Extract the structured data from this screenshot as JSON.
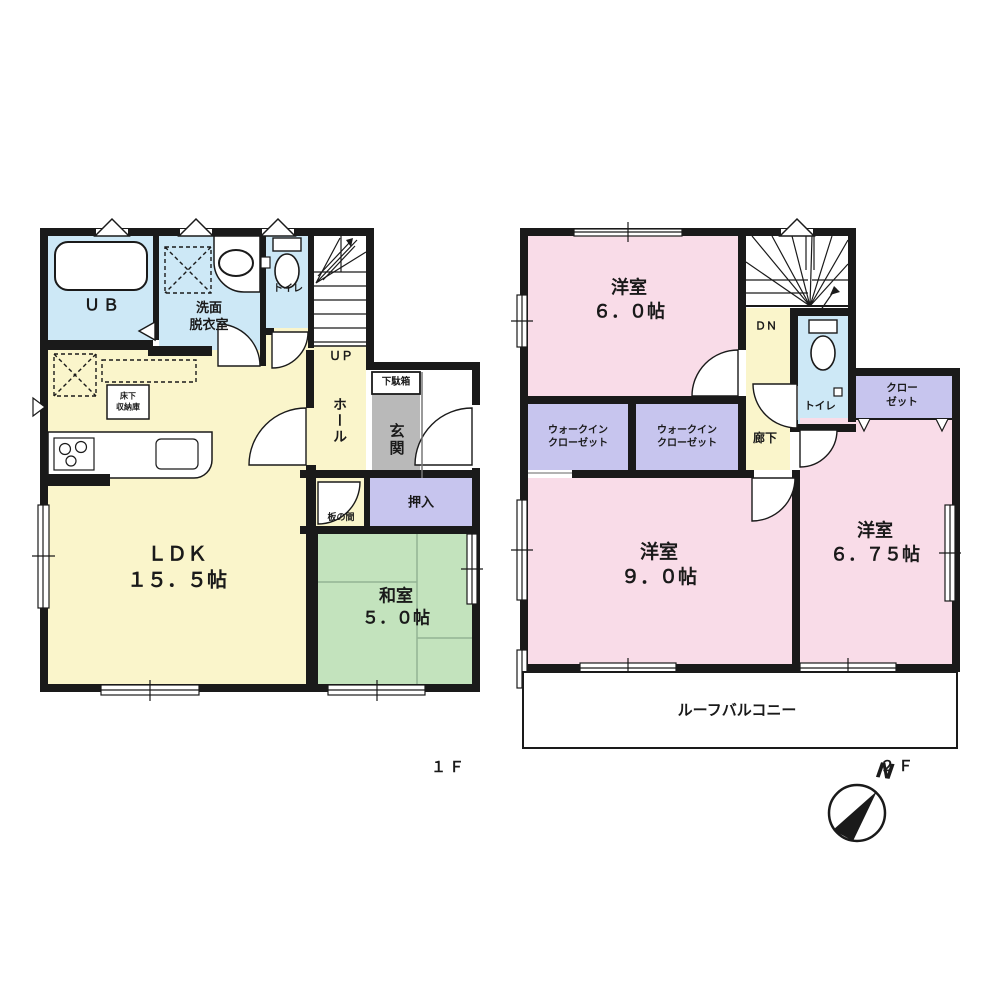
{
  "colors": {
    "wall": "#1A1A1A",
    "wood_floor": "#FAF5CB",
    "wet_area": "#CDE8F6",
    "tatami": "#C3E3BD",
    "storage": "#C7C5EE",
    "bedroom": "#F9DCE8",
    "entrance_gray": "#B9B9B9",
    "white": "#FFFFFF"
  },
  "f1": {
    "floor_label": "１Ｆ",
    "ub": "ＵＢ",
    "washroom": "洗面\n脱衣室",
    "toilet": "トイレ",
    "up": "ＵＰ",
    "hall": "ホール",
    "shoebox": "下駄箱",
    "entrance": "玄関",
    "underfloor_storage": "床下\n収納庫",
    "ldk": "ＬＤＫ\n１５．５帖",
    "itanoma": "板の間",
    "oshiire": "押入",
    "washitsu": "和室\n５．０帖"
  },
  "f2": {
    "floor_label": "２Ｆ",
    "bedroom6": "洋室\n６．０帖",
    "dn": "ＤＮ",
    "toilet": "トイレ",
    "closet": "クロー\nゼット",
    "wic1": "ウォークイン\nクローゼット",
    "wic2": "ウォークイン\nクローゼット",
    "hallway": "廊下",
    "bedroom9": "洋室\n９．０帖",
    "bedroom675": "洋室\n６．７５帖",
    "roof_balcony": "ルーフバルコニー"
  },
  "compass": {
    "north": "N"
  }
}
